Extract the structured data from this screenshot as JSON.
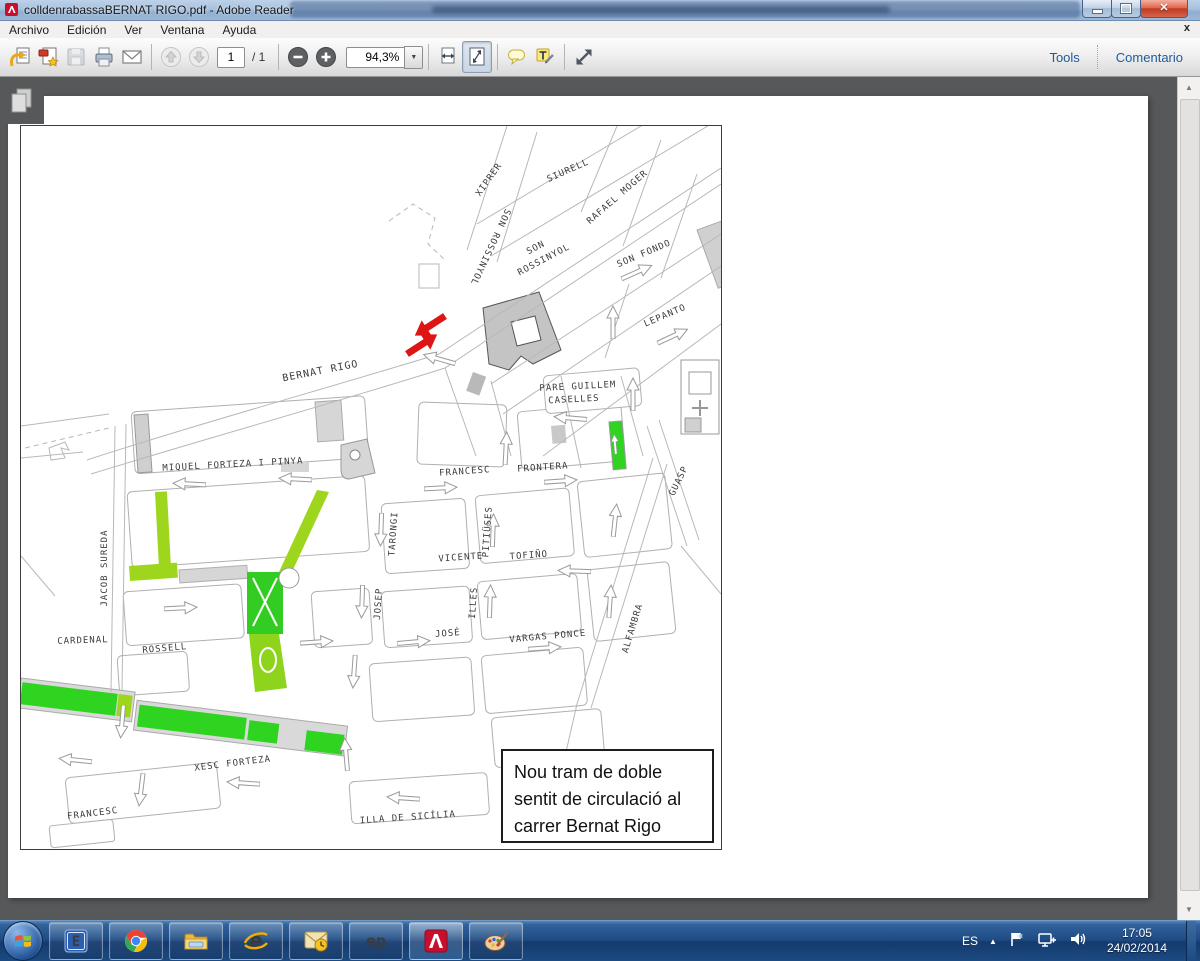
{
  "window": {
    "title": "colldenrabassaBERNAT RIGO.pdf - Adobe Reader",
    "close_glyph": "✕"
  },
  "menu": {
    "items": [
      "Archivo",
      "Edición",
      "Ver",
      "Ventana",
      "Ayuda"
    ],
    "doc_close_glyph": "x"
  },
  "toolbar": {
    "page_current": "1",
    "page_total": "/ 1",
    "zoom_value": "94,3%",
    "zoom_dd_glyph": "▼",
    "tools_label": "Tools",
    "comment_label": "Comentario"
  },
  "scrollbar": {
    "up_glyph": "▲",
    "down_glyph": "▼"
  },
  "map": {
    "annotation_lines": [
      "Nou tram de doble",
      "sentit de circulació al",
      "carrer Bernat Rigo"
    ],
    "highlight_green": "#2ed41f",
    "highlight_yellowgreen": "#9ed61e",
    "arrow_red": "#dd1515",
    "labels": [
      {
        "t": "XIPRER",
        "x": 470,
        "y": 55,
        "r": -55
      },
      {
        "t": "SIURELL",
        "x": 548,
        "y": 47,
        "r": -24
      },
      {
        "t": "RAFAEL MOGER",
        "x": 598,
        "y": 73,
        "r": -41
      },
      {
        "t": "SON ROSSINYOL",
        "x": 467,
        "y": 120,
        "r": 115
      },
      {
        "t": "SON",
        "x": 516,
        "y": 124,
        "r": -28
      },
      {
        "t": "ROSSINYOL",
        "x": 524,
        "y": 136,
        "r": -28
      },
      {
        "t": "SON FONDO",
        "x": 624,
        "y": 130,
        "r": -23
      },
      {
        "t": "LEPANTO",
        "x": 645,
        "y": 192,
        "r": -23
      },
      {
        "t": "BERNAT RIGO",
        "x": 300,
        "y": 248,
        "r": -11,
        "s": 10
      },
      {
        "t": "PARE GUILLEM",
        "x": 557,
        "y": 263,
        "r": -3
      },
      {
        "t": "CASELLES",
        "x": 553,
        "y": 276,
        "r": -3
      },
      {
        "t": "GUASP",
        "x": 660,
        "y": 356,
        "r": -64
      },
      {
        "t": "MIQUEL FORTEZA I PINYA",
        "x": 212,
        "y": 341,
        "r": -3
      },
      {
        "t": "FRANCESC",
        "x": 444,
        "y": 348,
        "r": -4
      },
      {
        "t": "FRONTERA",
        "x": 522,
        "y": 344,
        "r": -4
      },
      {
        "t": "JACOB SUREDA",
        "x": 86,
        "y": 442,
        "r": -90
      },
      {
        "t": "TARONGI",
        "x": 375,
        "y": 408,
        "r": -86
      },
      {
        "t": "PITIÜSES",
        "x": 469,
        "y": 406,
        "r": -86
      },
      {
        "t": "VICENTE",
        "x": 440,
        "y": 434,
        "r": -4
      },
      {
        "t": "TOFIÑO",
        "x": 508,
        "y": 432,
        "r": -4
      },
      {
        "t": "JOSEP",
        "x": 360,
        "y": 478,
        "r": -86
      },
      {
        "t": "ILLES",
        "x": 455,
        "y": 477,
        "r": -86
      },
      {
        "t": "JOSÉ",
        "x": 427,
        "y": 510,
        "r": -4
      },
      {
        "t": "VARGAS PONCE",
        "x": 527,
        "y": 513,
        "r": -5
      },
      {
        "t": "ALFAMBRA",
        "x": 614,
        "y": 503,
        "r": -73
      },
      {
        "t": "CARDENAL",
        "x": 62,
        "y": 517,
        "r": -2
      },
      {
        "t": "ROSSELL",
        "x": 144,
        "y": 525,
        "r": -5
      },
      {
        "t": "XESC FORTEZA",
        "x": 212,
        "y": 640,
        "r": -7
      },
      {
        "t": "FRANCESC",
        "x": 72,
        "y": 690,
        "r": -7
      },
      {
        "t": "ILLA DE SICÍLIA",
        "x": 387,
        "y": 694,
        "r": -4
      }
    ]
  },
  "taskbar": {
    "language": "ES",
    "tray_expand_glyph": "▲",
    "time": "17:05",
    "date": "24/02/2014"
  }
}
